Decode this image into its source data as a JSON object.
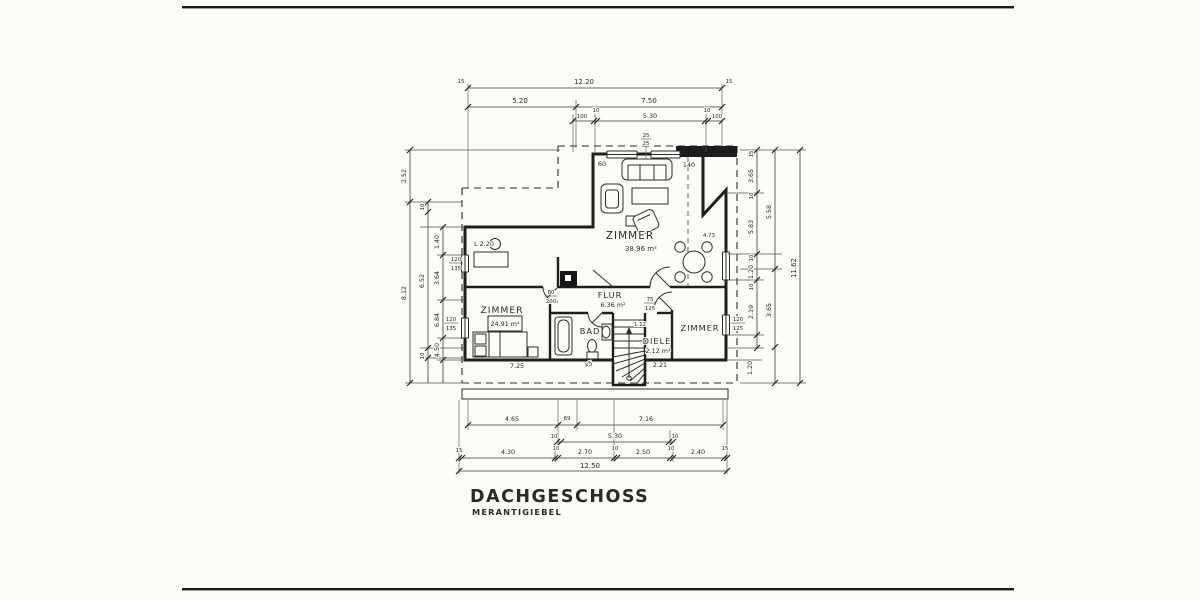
{
  "meta": {
    "title": "DACHGESCHOSS",
    "subtitle": "MERANTIGIEBEL"
  },
  "rooms": {
    "zimmer_main": {
      "name": "ZIMMER",
      "area": "38.96 m²"
    },
    "zimmer_left": {
      "name": "ZIMMER",
      "area": "24.91 m²"
    },
    "zimmer_right": {
      "name": "ZIMMER"
    },
    "flur": {
      "name": "FLUR",
      "area": "6.36 m²"
    },
    "bad": {
      "name": "BAD"
    },
    "diele": {
      "name": "DIELE",
      "area": "2.12 m²"
    }
  },
  "dims": {
    "top": {
      "tick_left": "15",
      "total": "12.20",
      "tick_right": "15",
      "seg": [
        "5.20",
        "7.50"
      ],
      "r3": [
        "100",
        "10",
        "5.30",
        "10",
        "100"
      ]
    },
    "bottom": {
      "r1": [
        "4.65",
        "69",
        "7.16"
      ],
      "r2": [
        "10",
        "5.30",
        "10"
      ],
      "r3": [
        "15",
        "4.30",
        "10",
        "2.70",
        "10",
        "2.50",
        "10",
        "2.40",
        "15"
      ],
      "total": "12.50"
    },
    "left": {
      "outer": [
        "2.52",
        "8.12"
      ],
      "mid": [
        "10",
        "6.52",
        "10"
      ],
      "inner": [
        "1.40",
        "3.64",
        "6.84",
        "4.50"
      ]
    },
    "right": {
      "inner": [
        "15",
        "3.65",
        "10",
        "5.83",
        "10",
        "1.20",
        "10",
        "2.19"
      ],
      "mid": [
        "5.58",
        "3.65"
      ],
      "outer": "11.62",
      "bottom": "1.20"
    }
  },
  "annotations": {
    "knee_left": "60",
    "knee_right": "140",
    "dim_473": "4.73",
    "l_height": "L 2.20",
    "note_x5": "x5",
    "mark_left": "7.25",
    "mark_right": "2.21",
    "stair_note": "1.12"
  },
  "chimney": {
    "w": "25",
    "h": "25"
  },
  "windows": {
    "left_top": {
      "w": "120",
      "h": "135"
    },
    "left_bottom": {
      "w": "120",
      "h": "135"
    },
    "right": {
      "w": "120",
      "h": "125"
    }
  },
  "doors": {
    "flur": {
      "w": "80",
      "h": "200"
    },
    "diele": {
      "w": "75",
      "h": "125"
    }
  }
}
